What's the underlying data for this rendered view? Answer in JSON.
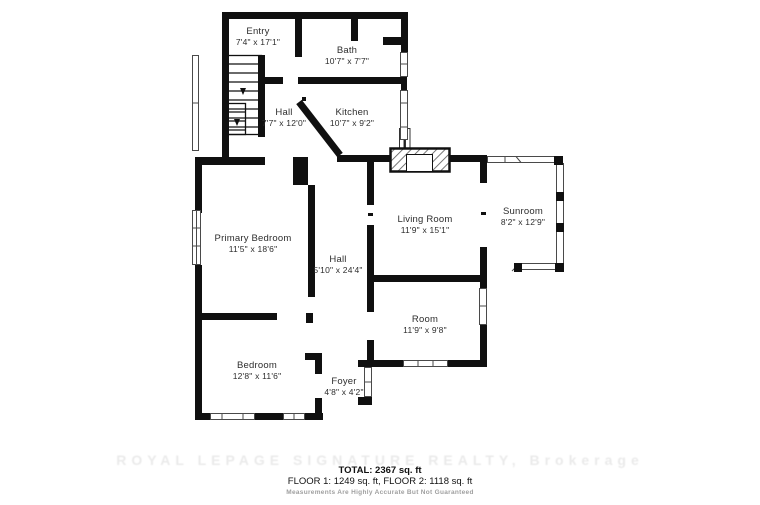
{
  "title": "Floor Plan",
  "colors": {
    "wall": "#101010",
    "background": "#ffffff",
    "label_text": "#2d2d2d",
    "disclaimer_text": "#9f9f9f",
    "watermark_text": "rgba(50,50,50,0.10)"
  },
  "watermark": {
    "text": "ROYAL LEPAGE SIGNATURE REALTY, Brokerage"
  },
  "rooms": {
    "entry": {
      "name": "Entry",
      "dims": "7'4\" x 17'1\""
    },
    "bath": {
      "name": "Bath",
      "dims": "10'7\" x 7'7\""
    },
    "hall_upper": {
      "name": "Hall",
      "dims": "7'7\" x 12'0\""
    },
    "kitchen": {
      "name": "Kitchen",
      "dims": "10'7\" x 9'2\""
    },
    "primary_bedroom": {
      "name": "Primary Bedroom",
      "dims": "11'5\" x 18'6\""
    },
    "hall_main": {
      "name": "Hall",
      "dims": "5'10\" x 24'4\""
    },
    "living_room": {
      "name": "Living Room",
      "dims": "11'9\" x 15'1\""
    },
    "sunroom": {
      "name": "Sunroom",
      "dims": "8'2\" x 12'9\""
    },
    "room": {
      "name": "Room",
      "dims": "11'9\" x 9'8\""
    },
    "bedroom": {
      "name": "Bedroom",
      "dims": "12'8\" x 11'6\""
    },
    "foyer": {
      "name": "Foyer",
      "dims": "4'8\" x 4'2\""
    }
  },
  "summary": {
    "total": "TOTAL: 2367 sq. ft",
    "floors": "FLOOR 1: 1249 sq. ft, FLOOR 2: 1118 sq. ft",
    "disclaimer": "Measurements Are Highly Accurate But Not Guaranteed"
  }
}
